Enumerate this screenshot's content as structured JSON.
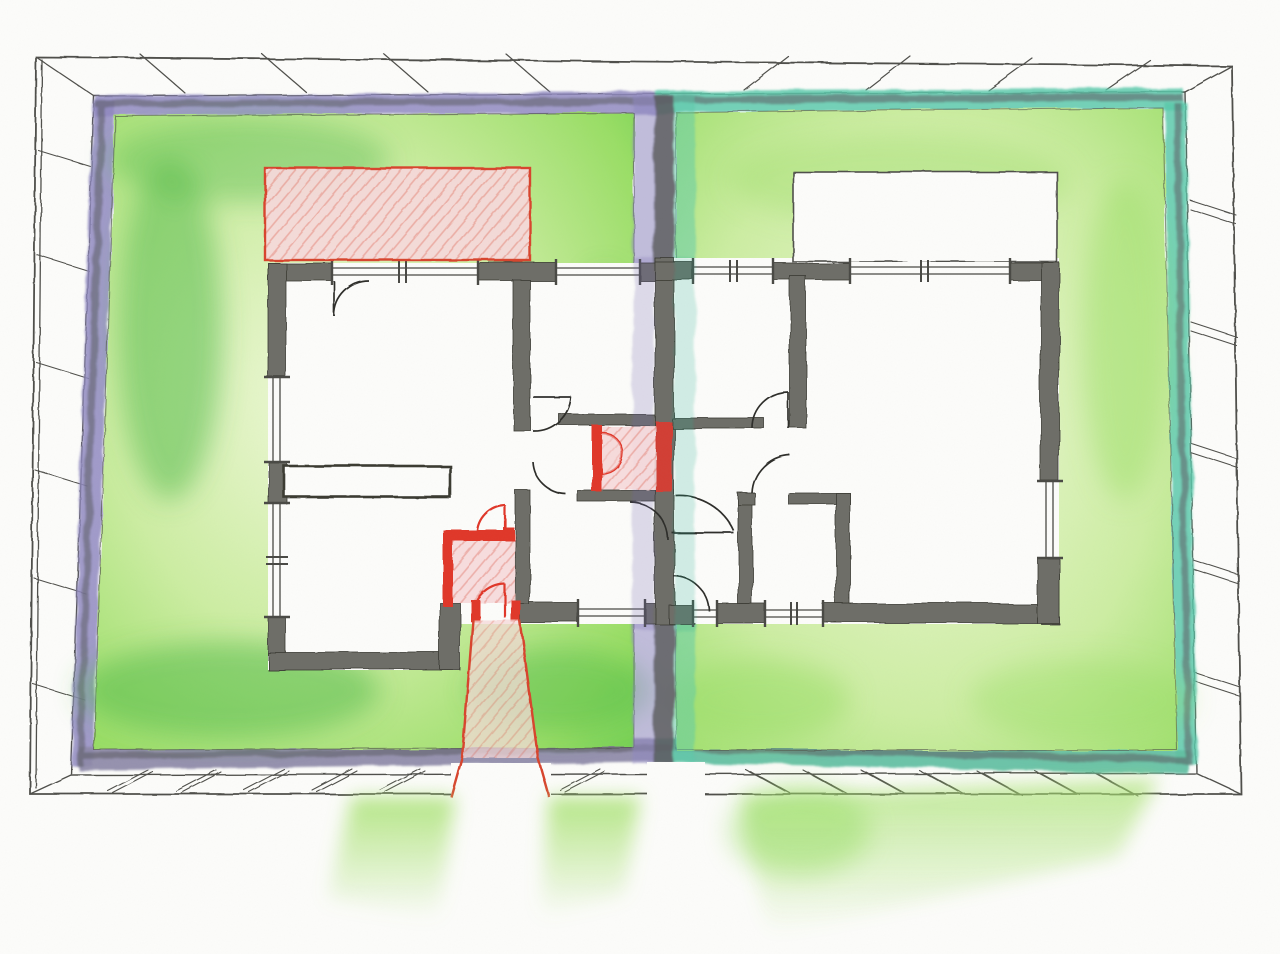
{
  "canvas": {
    "width": 1280,
    "height": 954,
    "background": "#fcfcfa"
  },
  "palette": {
    "paper": "#fcfcfa",
    "pencil_line": "#50504b",
    "wall_gray": "#6e6e67",
    "wall_edge": "#3a3a33",
    "window_line": "#4a4a45",
    "door_arc": "#2e2e2b",
    "purple_band": "#9089c1",
    "purple_deep": "#6f64ad",
    "teal_band": "#5cc9ab",
    "teal_deep": "#25ad92",
    "band_core": "#5d5d64",
    "band_bottom_left": "#8d89a8",
    "band_bottom_right": "#62bfa2",
    "lawn_pale": "#eef8d8",
    "lawn_light": "#cdeda3",
    "lawn_mid": "#9ade66",
    "lawn_deep": "#67cc4f",
    "lawn_shadow": "#4fba48",
    "red_outline": "#d8452f",
    "red_strong": "#e0392c",
    "pink_fill": "#f6d9da",
    "beam_green": "#a9e272"
  },
  "diagram_data": {
    "type": "architectural-floor-plan-sketch",
    "medium": "colored pencil / watercolor style hand drawing, no text labels",
    "view": "top-down plan of a walled rectangular plot drawn with slight perspective",
    "site": {
      "boundary": "masonry wall around the plot shown as a white band with diagonal hatch marks",
      "south_gates": "openings in the south wall with green light beams spilling outward",
      "divider": "central fence splitting the plot into two yards, violet on the left side, teal on the right side"
    },
    "units": [
      {
        "side": "left",
        "yard_border_color_key": "purple_band",
        "highlights": [
          "red terrace top-left",
          "red WC core at party wall",
          "red entry vestibule",
          "red entry path through south wall"
        ]
      },
      {
        "side": "right",
        "yard_border_color_key": "teal_band",
        "highlights": [
          "white paved terrace top-right"
        ]
      }
    ],
    "house": {
      "shared_party_wall": true,
      "walls": "thick gray pencil-shaded walls",
      "windows": 10,
      "door_swings": 12
    },
    "gardens": "soft green lawn wash wrapping both dwellings, brighter at the plot edges"
  }
}
